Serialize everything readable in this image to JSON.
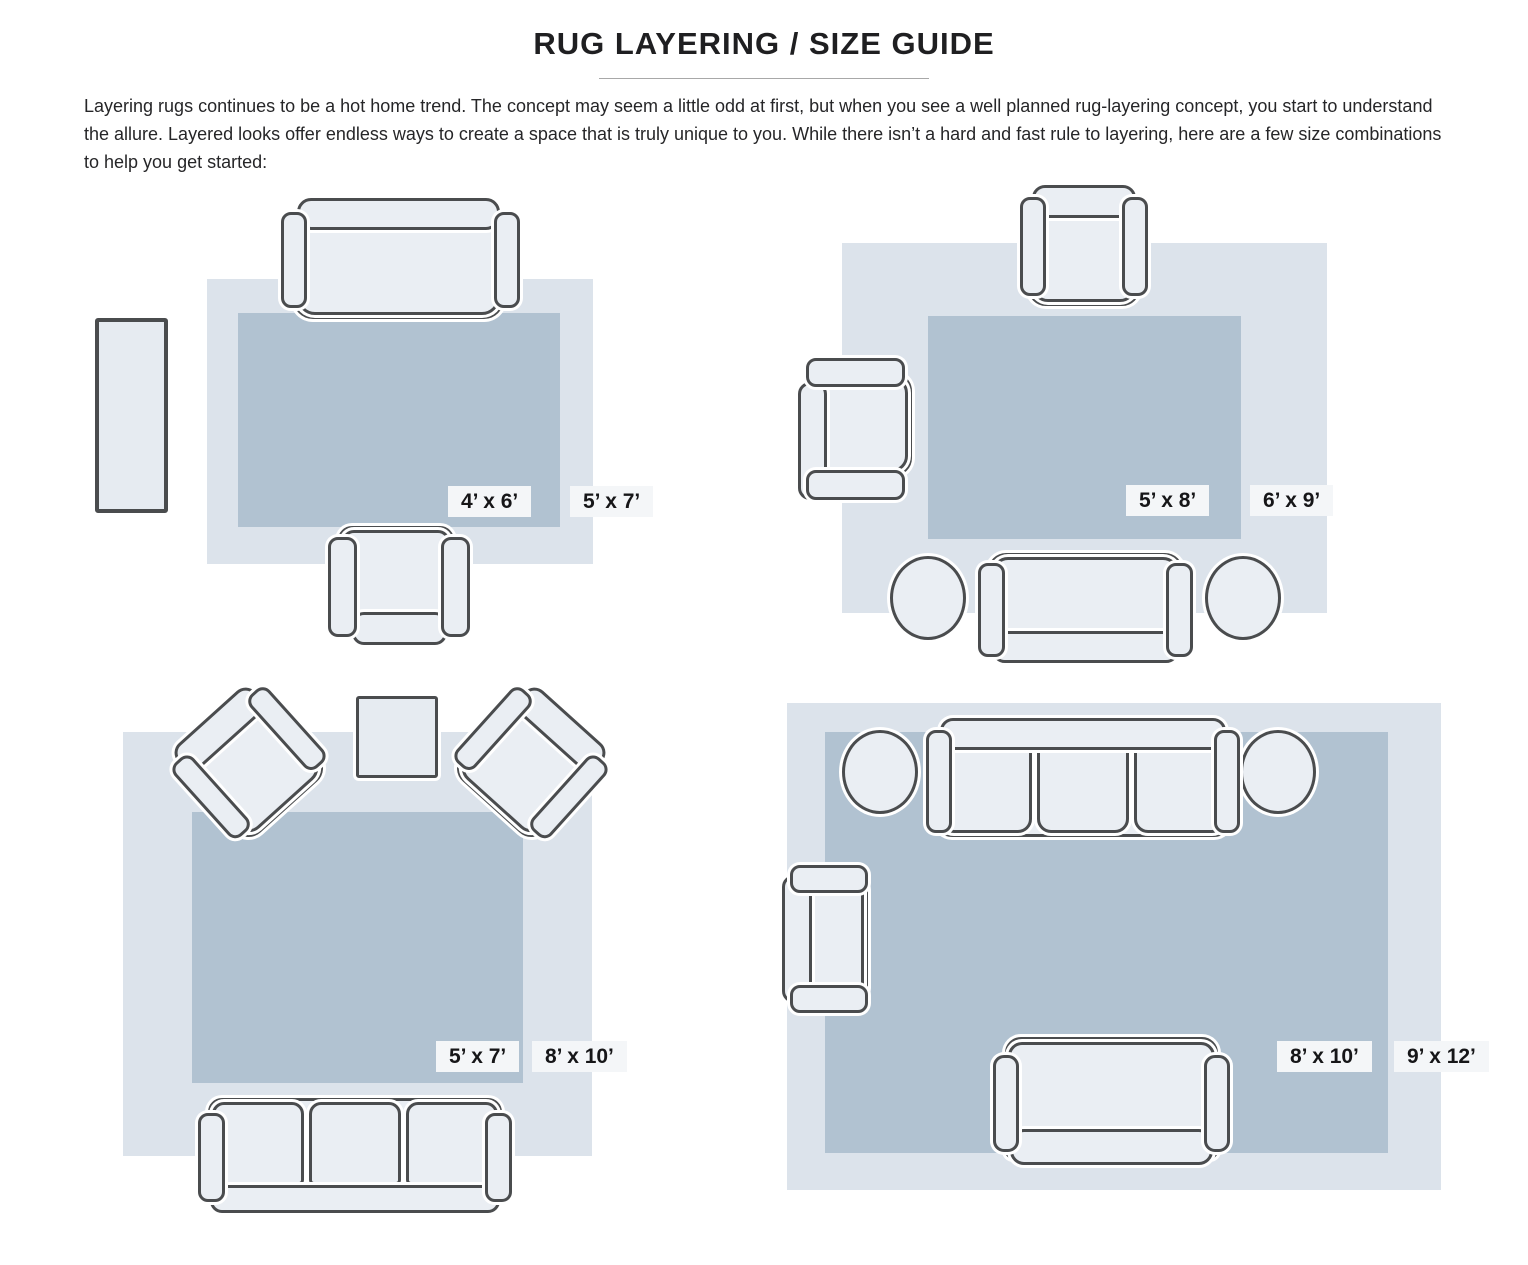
{
  "header": {
    "title": "RUG LAYERING / SIZE GUIDE",
    "paragraph": "Layering rugs continues to be a hot home trend. The concept may seem a little odd at first, but when you see a well planned rug-layering concept, you start to understand the allure. Layered looks offer endless ways to create a space that is truly unique to you. While there isn’t a hard and fast rule to layering, here are a few size combinations to help you get started:"
  },
  "colors": {
    "page_bg": "#ffffff",
    "outer_rug": "#dce3eb",
    "inner_rug": "#b1c2d1",
    "furniture_fill": "#eaeef3",
    "furniture_outline": "#4a4c4e",
    "table_fill": "#e6ebf1",
    "label_bg": "#f4f6f8",
    "text_color": "#1f1f21",
    "divider": "#a8a8a8"
  },
  "diagrams": [
    {
      "name": "loveseat-and-chair-layout",
      "inner_label": "4’ x 6’",
      "outer_label": "5’ x 7’",
      "inner_rug_size": "4x6",
      "outer_rug_size": "5x7",
      "furniture": [
        "loveseat-sofa",
        "armchair",
        "console-table"
      ]
    },
    {
      "name": "two-chairs-sofa-poufs-layout",
      "inner_label": "5’ x 8’",
      "outer_label": "6’ x 9’",
      "inner_rug_size": "5x8",
      "outer_rug_size": "6x9",
      "furniture": [
        "armchair",
        "armchair",
        "loveseat-sofa",
        "pouf",
        "pouf"
      ]
    },
    {
      "name": "angled-chairs-sofa-layout",
      "inner_label": "5’ x 7’",
      "outer_label": "8’ x 10’",
      "inner_rug_size": "5x7",
      "outer_rug_size": "8x10",
      "furniture": [
        "armchair",
        "armchair",
        "round-table",
        "three-seat-sofa"
      ]
    },
    {
      "name": "sofa-poufs-chair-loveseat-layout",
      "inner_label": "8’ x 10’",
      "outer_label": "9’ x 12’",
      "inner_rug_size": "8x10",
      "outer_rug_size": "9x12",
      "furniture": [
        "three-seat-sofa",
        "pouf",
        "pouf",
        "armchair",
        "loveseat-sofa"
      ]
    }
  ]
}
